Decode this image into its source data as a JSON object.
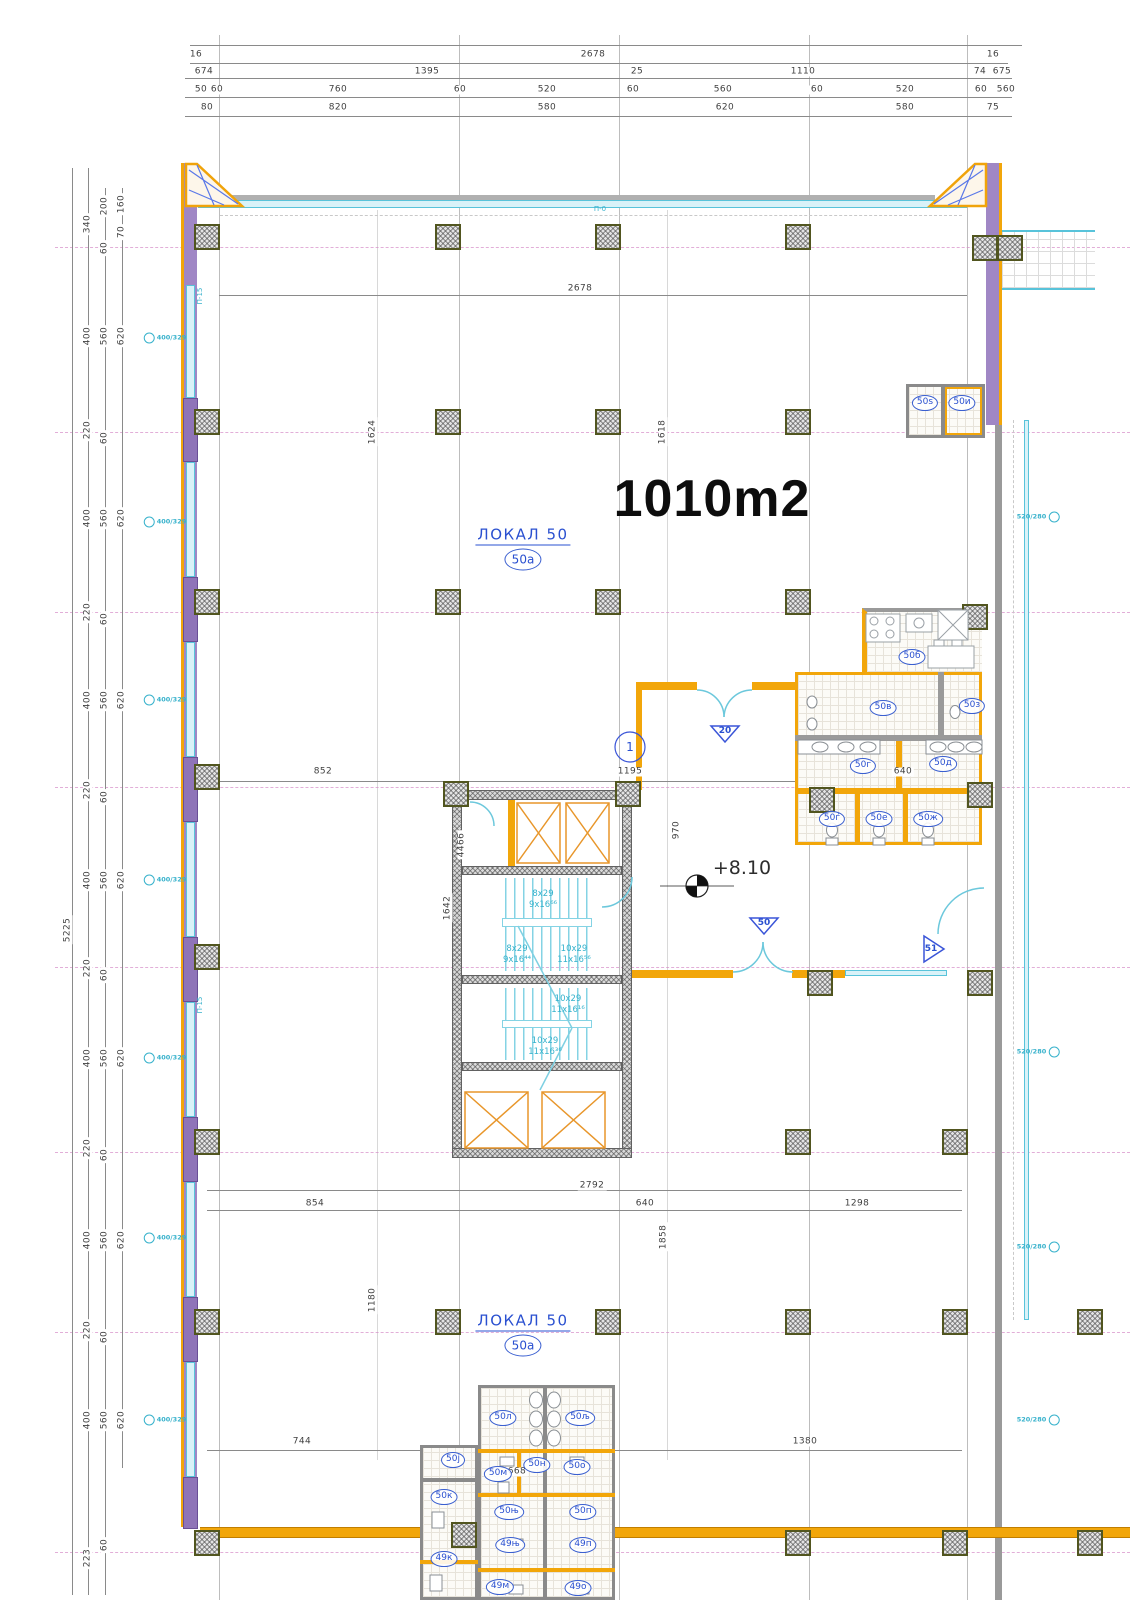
{
  "area_label": "1010m2",
  "elevation_label": "+8.10",
  "colors": {
    "accent_orange": "#f2a60a",
    "wall_purple": "#a087c5",
    "window_cyan": "#58c3da",
    "label_blue": "#2a50d0",
    "dim_gray": "#3f3f3f",
    "axis_pink": "#d58cc8"
  },
  "locals": [
    {
      "name": "ЛОКАЛ  50",
      "tag": "50а",
      "x": 523,
      "y": 548
    },
    {
      "name": "ЛОКАЛ  50",
      "tag": "50а",
      "x": 523,
      "y": 1334
    }
  ],
  "dims_top": [
    {
      "t": "16",
      "x": 196,
      "y": 55
    },
    {
      "t": "2678",
      "x": 593,
      "y": 55
    },
    {
      "t": "16",
      "x": 993,
      "y": 55
    },
    {
      "t": "674",
      "x": 204,
      "y": 72
    },
    {
      "t": "1395",
      "x": 427,
      "y": 72
    },
    {
      "t": "25",
      "x": 637,
      "y": 72
    },
    {
      "t": "1110",
      "x": 803,
      "y": 72
    },
    {
      "t": "74",
      "x": 980,
      "y": 72
    },
    {
      "t": "675",
      "x": 1002,
      "y": 72
    },
    {
      "t": "50",
      "x": 201,
      "y": 90
    },
    {
      "t": "60",
      "x": 217,
      "y": 90
    },
    {
      "t": "760",
      "x": 338,
      "y": 90
    },
    {
      "t": "60",
      "x": 460,
      "y": 90
    },
    {
      "t": "520",
      "x": 547,
      "y": 90
    },
    {
      "t": "60",
      "x": 633,
      "y": 90
    },
    {
      "t": "560",
      "x": 723,
      "y": 90
    },
    {
      "t": "60",
      "x": 817,
      "y": 90
    },
    {
      "t": "520",
      "x": 905,
      "y": 90
    },
    {
      "t": "60",
      "x": 981,
      "y": 90
    },
    {
      "t": "560",
      "x": 1006,
      "y": 90
    },
    {
      "t": "80",
      "x": 207,
      "y": 108
    },
    {
      "t": "820",
      "x": 338,
      "y": 108
    },
    {
      "t": "580",
      "x": 547,
      "y": 108
    },
    {
      "t": "620",
      "x": 725,
      "y": 108
    },
    {
      "t": "580",
      "x": 905,
      "y": 108
    },
    {
      "t": "75",
      "x": 993,
      "y": 108
    }
  ],
  "dims_left": [
    {
      "t": "340",
      "x": 88,
      "y": 224
    },
    {
      "t": "200",
      "x": 105,
      "y": 206
    },
    {
      "t": "160",
      "x": 122,
      "y": 204
    },
    {
      "t": "70",
      "x": 122,
      "y": 232
    },
    {
      "t": "60",
      "x": 105,
      "y": 248
    },
    {
      "t": "400",
      "x": 88,
      "y": 336
    },
    {
      "t": "560",
      "x": 105,
      "y": 336
    },
    {
      "t": "620",
      "x": 122,
      "y": 336
    },
    {
      "t": "220",
      "x": 88,
      "y": 430
    },
    {
      "t": "60",
      "x": 105,
      "y": 438
    },
    {
      "t": "400",
      "x": 88,
      "y": 518
    },
    {
      "t": "560",
      "x": 105,
      "y": 518
    },
    {
      "t": "620",
      "x": 122,
      "y": 518
    },
    {
      "t": "220",
      "x": 88,
      "y": 612
    },
    {
      "t": "60",
      "x": 105,
      "y": 619
    },
    {
      "t": "400",
      "x": 88,
      "y": 700
    },
    {
      "t": "560",
      "x": 105,
      "y": 700
    },
    {
      "t": "620",
      "x": 122,
      "y": 700
    },
    {
      "t": "220",
      "x": 88,
      "y": 790
    },
    {
      "t": "60",
      "x": 105,
      "y": 797
    },
    {
      "t": "400",
      "x": 88,
      "y": 880
    },
    {
      "t": "560",
      "x": 105,
      "y": 880
    },
    {
      "t": "620",
      "x": 122,
      "y": 880
    },
    {
      "t": "220",
      "x": 88,
      "y": 968
    },
    {
      "t": "60",
      "x": 105,
      "y": 975
    },
    {
      "t": "400",
      "x": 88,
      "y": 1058
    },
    {
      "t": "560",
      "x": 105,
      "y": 1058
    },
    {
      "t": "620",
      "x": 122,
      "y": 1058
    },
    {
      "t": "220",
      "x": 88,
      "y": 1148
    },
    {
      "t": "60",
      "x": 105,
      "y": 1155
    },
    {
      "t": "400",
      "x": 88,
      "y": 1240
    },
    {
      "t": "560",
      "x": 105,
      "y": 1240
    },
    {
      "t": "620",
      "x": 122,
      "y": 1240
    },
    {
      "t": "220",
      "x": 88,
      "y": 1330
    },
    {
      "t": "60",
      "x": 105,
      "y": 1337
    },
    {
      "t": "400",
      "x": 88,
      "y": 1420
    },
    {
      "t": "560",
      "x": 105,
      "y": 1420
    },
    {
      "t": "620",
      "x": 122,
      "y": 1420
    },
    {
      "t": "223",
      "x": 88,
      "y": 1558
    },
    {
      "t": "60",
      "x": 105,
      "y": 1545
    },
    {
      "t": "5225",
      "x": 68,
      "y": 930
    }
  ],
  "dims_inner": [
    {
      "t": "2678",
      "x": 580,
      "y": 289
    },
    {
      "t": "1624",
      "x": 373,
      "y": 432,
      "rot": 1
    },
    {
      "t": "1618",
      "x": 663,
      "y": 432,
      "rot": 1
    },
    {
      "t": "852",
      "x": 323,
      "y": 772
    },
    {
      "t": "1195",
      "x": 630,
      "y": 772
    },
    {
      "t": "640",
      "x": 903,
      "y": 772
    },
    {
      "t": "4466",
      "x": 462,
      "y": 845,
      "rot": 1
    },
    {
      "t": "1642",
      "x": 448,
      "y": 908,
      "rot": 1
    },
    {
      "t": "970",
      "x": 677,
      "y": 830,
      "rot": 1
    },
    {
      "t": "2792",
      "x": 592,
      "y": 1186
    },
    {
      "t": "854",
      "x": 315,
      "y": 1204
    },
    {
      "t": "640",
      "x": 645,
      "y": 1204
    },
    {
      "t": "1298",
      "x": 857,
      "y": 1204
    },
    {
      "t": "1858",
      "x": 664,
      "y": 1237,
      "rot": 1
    },
    {
      "t": "1180",
      "x": 373,
      "y": 1300,
      "rot": 1
    },
    {
      "t": "744",
      "x": 302,
      "y": 1442
    },
    {
      "t": "668",
      "x": 517,
      "y": 1472
    },
    {
      "t": "1380",
      "x": 805,
      "y": 1442
    }
  ],
  "rooms": [
    {
      "t": "50ѕ",
      "x": 925,
      "y": 403
    },
    {
      "t": "50и",
      "x": 962,
      "y": 403
    },
    {
      "t": "50б",
      "x": 912,
      "y": 657
    },
    {
      "t": "50в",
      "x": 883,
      "y": 708
    },
    {
      "t": "50з",
      "x": 972,
      "y": 706
    },
    {
      "t": "50г",
      "x": 863,
      "y": 766
    },
    {
      "t": "50д",
      "x": 943,
      "y": 764
    },
    {
      "t": "50ѓ",
      "x": 832,
      "y": 819
    },
    {
      "t": "50е",
      "x": 879,
      "y": 819
    },
    {
      "t": "50ж",
      "x": 928,
      "y": 819
    },
    {
      "t": "50л",
      "x": 503,
      "y": 1418
    },
    {
      "t": "50љ",
      "x": 580,
      "y": 1418
    },
    {
      "t": "50ј",
      "x": 453,
      "y": 1460
    },
    {
      "t": "50м",
      "x": 498,
      "y": 1474
    },
    {
      "t": "50н",
      "x": 537,
      "y": 1465
    },
    {
      "t": "50о",
      "x": 577,
      "y": 1467
    },
    {
      "t": "50к",
      "x": 444,
      "y": 1497
    },
    {
      "t": "50њ",
      "x": 509,
      "y": 1512
    },
    {
      "t": "50п",
      "x": 583,
      "y": 1512
    },
    {
      "t": "49њ",
      "x": 510,
      "y": 1545
    },
    {
      "t": "49п",
      "x": 583,
      "y": 1545
    },
    {
      "t": "49к",
      "x": 444,
      "y": 1559
    },
    {
      "t": "49м",
      "x": 500,
      "y": 1587
    },
    {
      "t": "49о",
      "x": 578,
      "y": 1588
    }
  ],
  "stair_labels": [
    {
      "a": "8x29",
      "b": "9x16⁶⁶",
      "x": 543,
      "y": 900
    },
    {
      "a": "8x29",
      "b": "9x16⁴⁴",
      "x": 517,
      "y": 955
    },
    {
      "a": "10x29",
      "b": "11x16⁵⁶",
      "x": 574,
      "y": 955
    },
    {
      "a": "10x29",
      "b": "11x16¹⁶",
      "x": 568,
      "y": 1005
    },
    {
      "a": "10x29",
      "b": "11x16³⁶",
      "x": 545,
      "y": 1047
    }
  ],
  "markers": [
    {
      "t": "1",
      "x": 630,
      "y": 747,
      "big": 1
    },
    {
      "t": "20",
      "x": 725,
      "y": 731
    },
    {
      "t": "50",
      "x": 764,
      "y": 923
    },
    {
      "t": "51",
      "x": 931,
      "y": 949
    }
  ],
  "window_tags_left": [
    {
      "t": "400/329",
      "x": 165,
      "y": 338
    },
    {
      "t": "400/329",
      "x": 165,
      "y": 522
    },
    {
      "t": "400/329",
      "x": 165,
      "y": 700
    },
    {
      "t": "400/329",
      "x": 165,
      "y": 880
    },
    {
      "t": "400/329",
      "x": 165,
      "y": 1058
    },
    {
      "t": "400/329",
      "x": 165,
      "y": 1238
    },
    {
      "t": "400/329",
      "x": 165,
      "y": 1420
    }
  ],
  "window_tags_right": [
    {
      "t": "520/280",
      "x": 1038,
      "y": 517
    },
    {
      "t": "520/280",
      "x": 1038,
      "y": 1052
    },
    {
      "t": "520/280",
      "x": 1038,
      "y": 1247
    },
    {
      "t": "520/280",
      "x": 1038,
      "y": 1420
    }
  ],
  "wall_tags": [
    {
      "t": "П-15",
      "x": 200,
      "y": 296,
      "rot": 1
    },
    {
      "t": "П-15",
      "x": 200,
      "y": 1005,
      "rot": 1
    },
    {
      "t": "П-0",
      "x": 600,
      "y": 209
    }
  ],
  "columns": [
    {
      "x": 207,
      "y": 237
    },
    {
      "x": 448,
      "y": 237
    },
    {
      "x": 608,
      "y": 237
    },
    {
      "x": 798,
      "y": 237
    },
    {
      "x": 985,
      "y": 248
    },
    {
      "x": 1010,
      "y": 248
    },
    {
      "x": 207,
      "y": 422
    },
    {
      "x": 448,
      "y": 422
    },
    {
      "x": 608,
      "y": 422
    },
    {
      "x": 798,
      "y": 422
    },
    {
      "x": 207,
      "y": 602
    },
    {
      "x": 448,
      "y": 602
    },
    {
      "x": 608,
      "y": 602
    },
    {
      "x": 798,
      "y": 602
    },
    {
      "x": 975,
      "y": 617
    },
    {
      "x": 207,
      "y": 777
    },
    {
      "x": 456,
      "y": 794
    },
    {
      "x": 628,
      "y": 794
    },
    {
      "x": 822,
      "y": 800
    },
    {
      "x": 980,
      "y": 795
    },
    {
      "x": 207,
      "y": 957
    },
    {
      "x": 820,
      "y": 983
    },
    {
      "x": 980,
      "y": 983
    },
    {
      "x": 207,
      "y": 1142
    },
    {
      "x": 798,
      "y": 1142
    },
    {
      "x": 955,
      "y": 1142
    },
    {
      "x": 207,
      "y": 1322
    },
    {
      "x": 448,
      "y": 1322
    },
    {
      "x": 608,
      "y": 1322
    },
    {
      "x": 798,
      "y": 1322
    },
    {
      "x": 955,
      "y": 1322
    },
    {
      "x": 1090,
      "y": 1322
    },
    {
      "x": 207,
      "y": 1543
    },
    {
      "x": 464,
      "y": 1535
    },
    {
      "x": 798,
      "y": 1543
    },
    {
      "x": 955,
      "y": 1543
    },
    {
      "x": 1090,
      "y": 1543
    }
  ]
}
